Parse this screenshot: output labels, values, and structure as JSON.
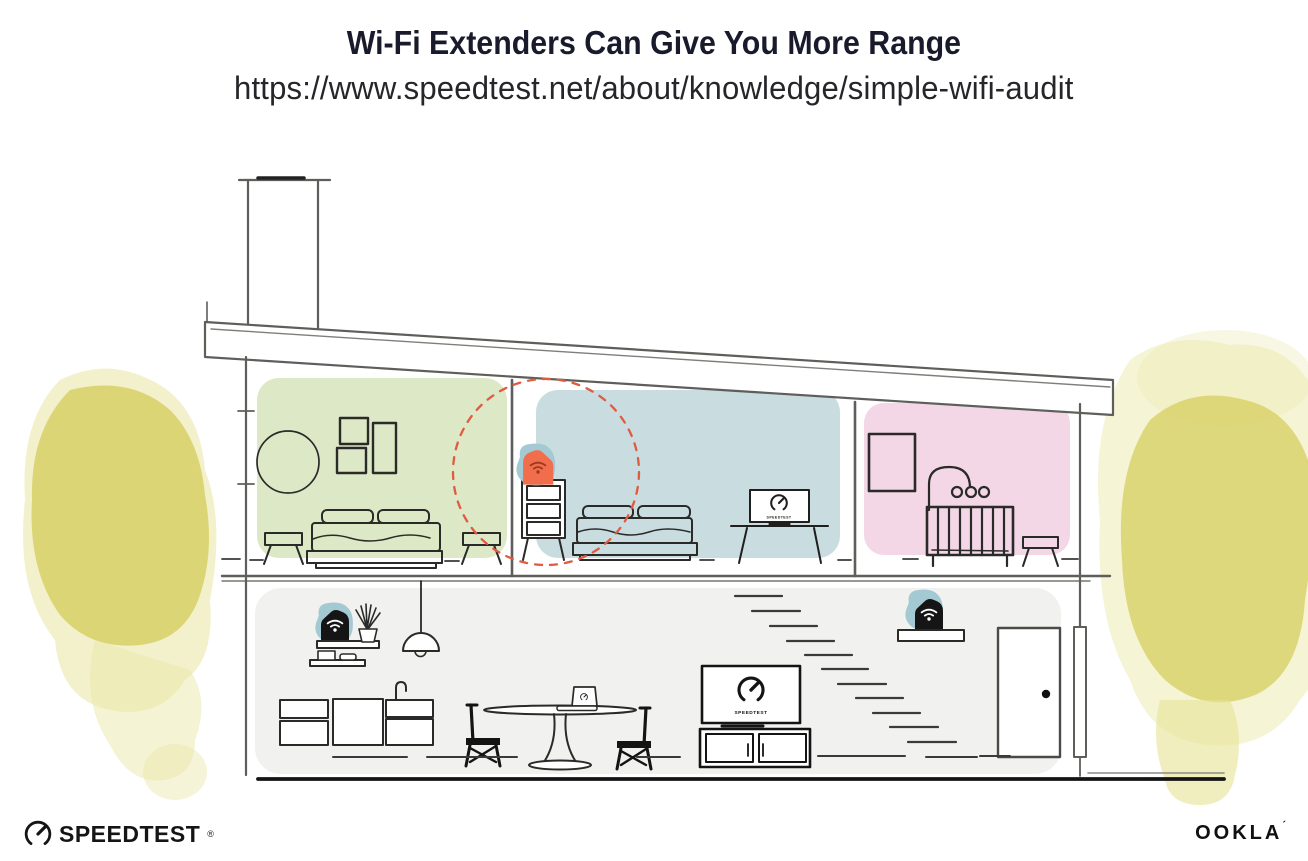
{
  "header": {
    "title": "Wi-Fi Extenders Can Give You More Range",
    "url": "https://www.speedtest.net/about/knowledge/simple-wifi-audit"
  },
  "illustration": {
    "description": "Cross-section of a two-story house showing a Wi-Fi extender placed upstairs on a dresser (dashed circle = extended coverage), with routers on shelves downstairs",
    "tv_screen_label": "SPEEDTEST",
    "colors": {
      "bedroom_green": "#dde8c6",
      "bedroom_blue": "#c9dce0",
      "nursery_pink": "#f3d7e6",
      "lower_floor_gray": "#f1f1ef",
      "device_teal": "#a3cad2",
      "extender_orange": "#f26d4b",
      "extender_wifi_maroon": "#9c3a20",
      "range_dashed_red": "#df5b41",
      "foliage_yellow": "#d9d26c",
      "structure_line_gray": "#5e5e5a",
      "furniture_line_black": "#1f1f1d"
    }
  },
  "footer": {
    "speedtest_label": "SPEEDTEST",
    "speedtest_mark": "®",
    "ookla_label": "OOKLA",
    "ookla_mark": "´"
  }
}
